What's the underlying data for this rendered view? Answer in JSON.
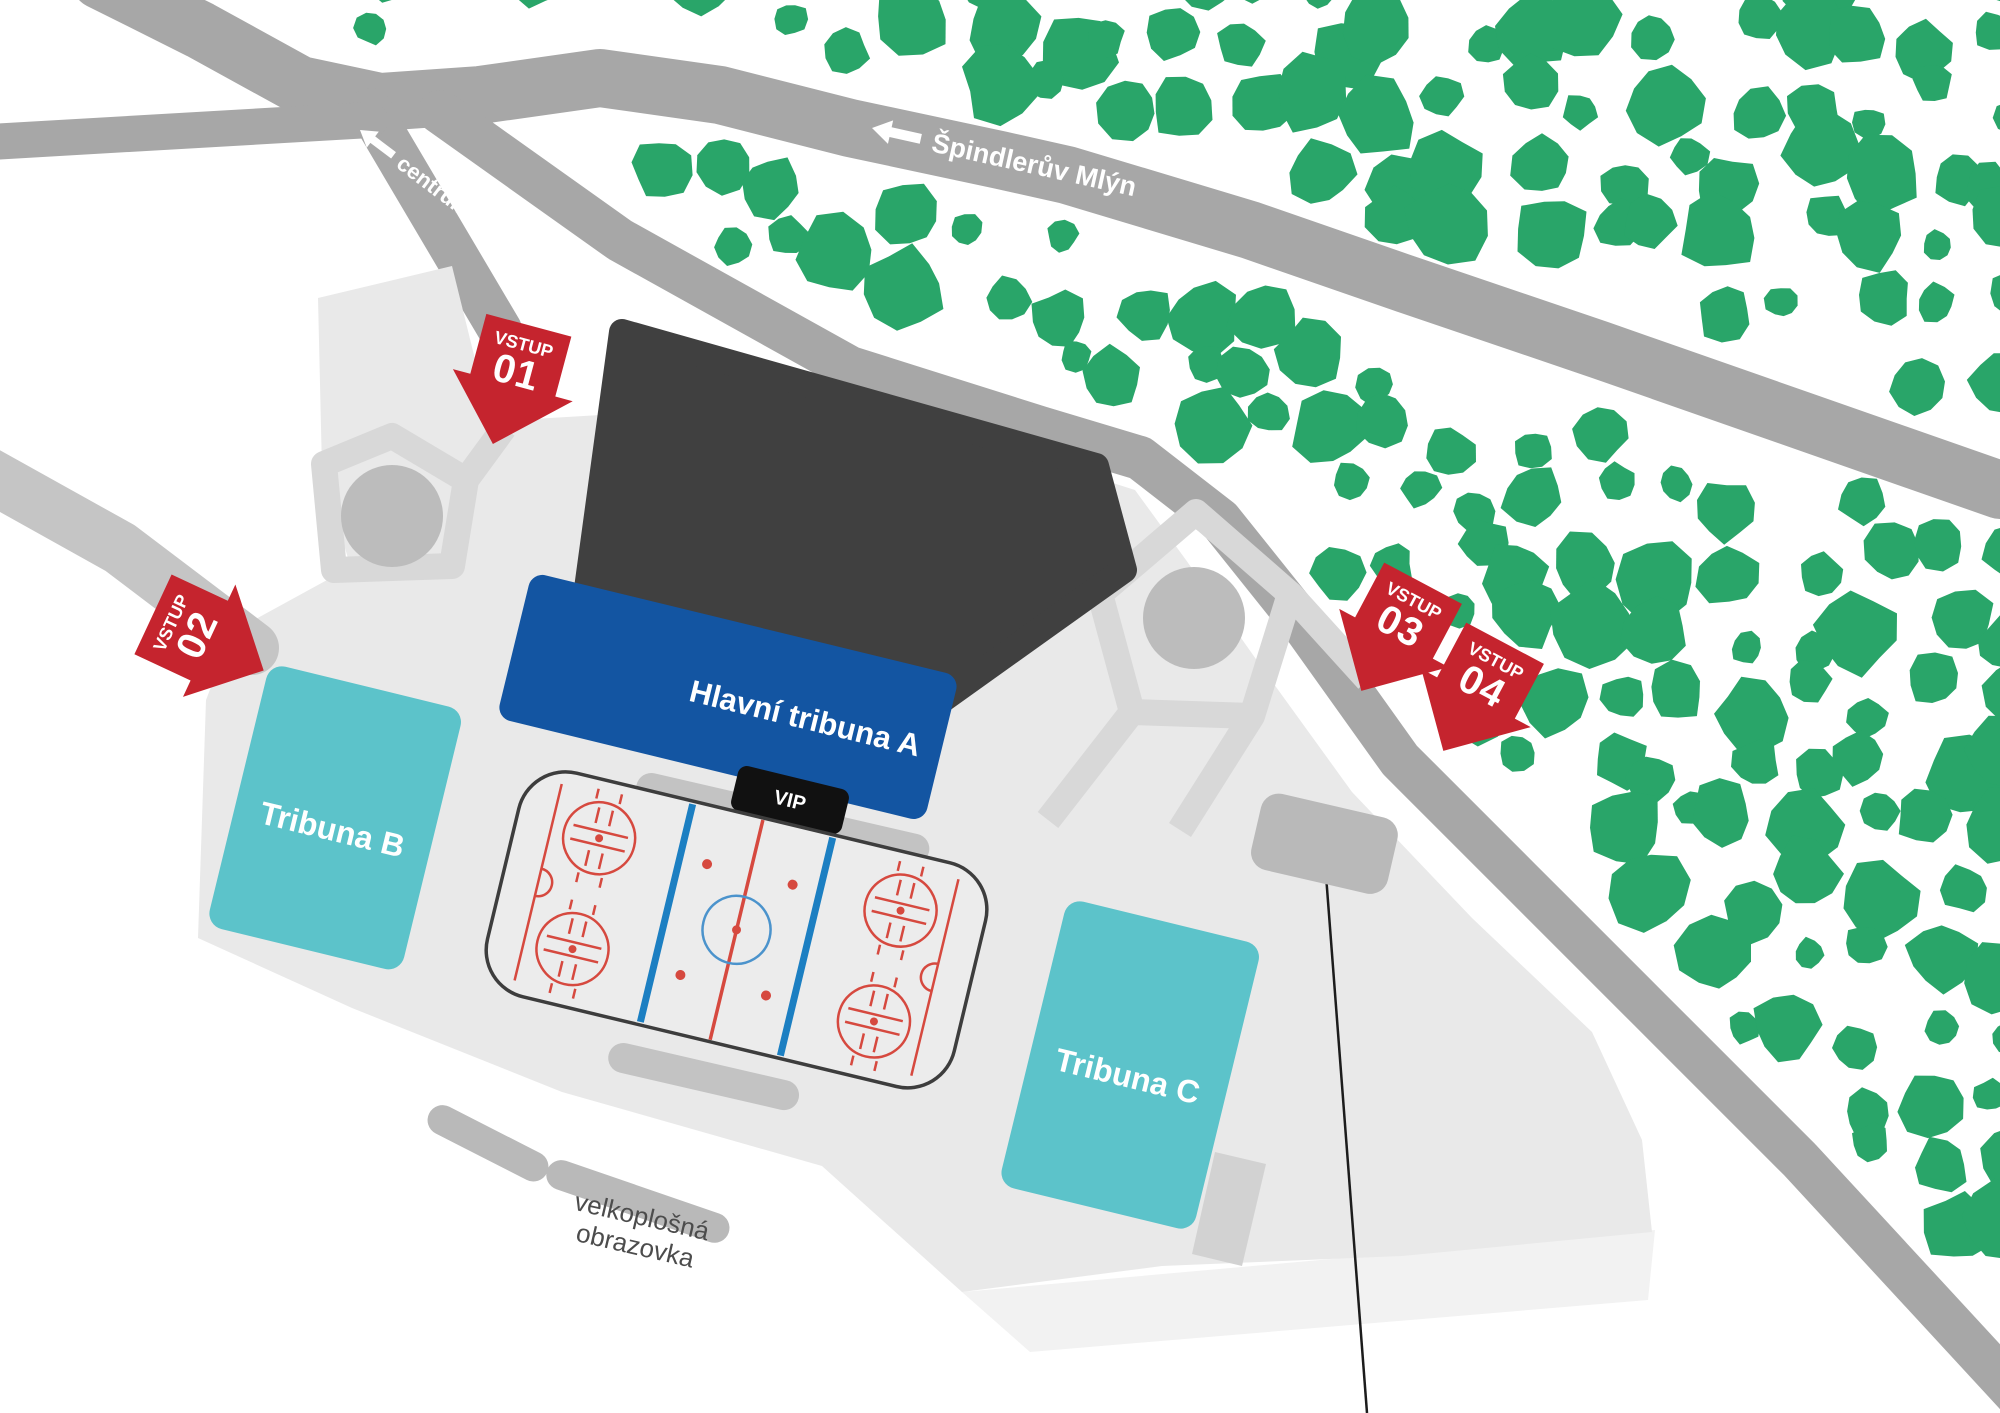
{
  "roads": {
    "highway_label": "Špindlerův Mlýn",
    "fork_label": "centrum města"
  },
  "stands": {
    "main": "Hlavní tribuna A",
    "b": "Tribuna B",
    "c": "Tribuna C",
    "vip": "VIP"
  },
  "big_screen": {
    "line1": "velkoplošná",
    "line2": "obrazovka"
  },
  "entrances": [
    {
      "label": "VSTUP",
      "number": "01"
    },
    {
      "label": "VSTUP",
      "number": "02"
    },
    {
      "label": "VSTUP",
      "number": "03"
    },
    {
      "label": "VSTUP",
      "number": "04"
    }
  ],
  "colors": {
    "tree_green": "#29a569",
    "road_gray": "#a7a7a7",
    "plaza_gray": "#e9e9e9",
    "path_gray": "#d8d8d8",
    "entrance_red": "#c5242e",
    "stand_blue": "#1355a2",
    "stand_cyan": "#5cc3ca",
    "building_dark": "#404040"
  }
}
